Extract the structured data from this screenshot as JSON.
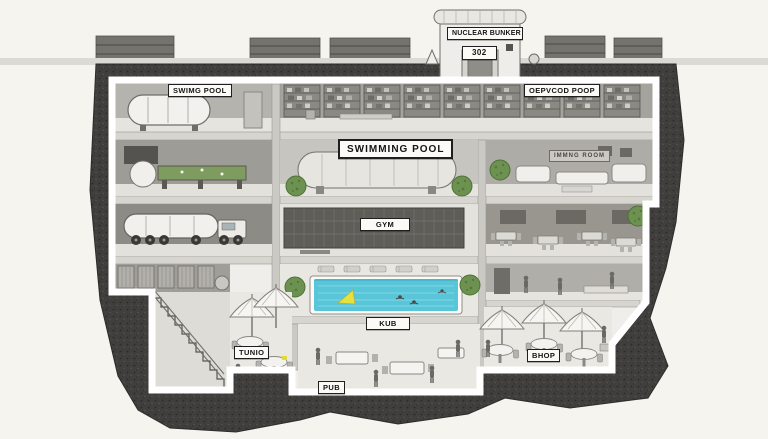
{
  "scene": {
    "type": "cutaway-illustration",
    "subject": "Underground nuclear bunker cross-section, multi-level, mostly grayscale ink style",
    "background_color": "#f6f4ef",
    "earth_color": "#403f3d",
    "ink_color": "#2c2c2c",
    "pool_water_color": "#58c5d8",
    "plant_green_color": "#6d9150",
    "float_yellow_color": "#e6e13e",
    "label_bg_color": "#fbfaf7"
  },
  "labels": {
    "tower_name": "NUCLEAR BUNKER",
    "tower_number": "302",
    "level1_left": "SWIMG POOL",
    "level1_right": "OEPVCOD POOP",
    "banner": "SWIMMING POOL",
    "living_room_sign": "IMMNG ROOM",
    "gym": "GYM",
    "pool_area": "KUB",
    "tunnel": "TUNIO",
    "shop": "BHOP",
    "pub": "PUB"
  }
}
